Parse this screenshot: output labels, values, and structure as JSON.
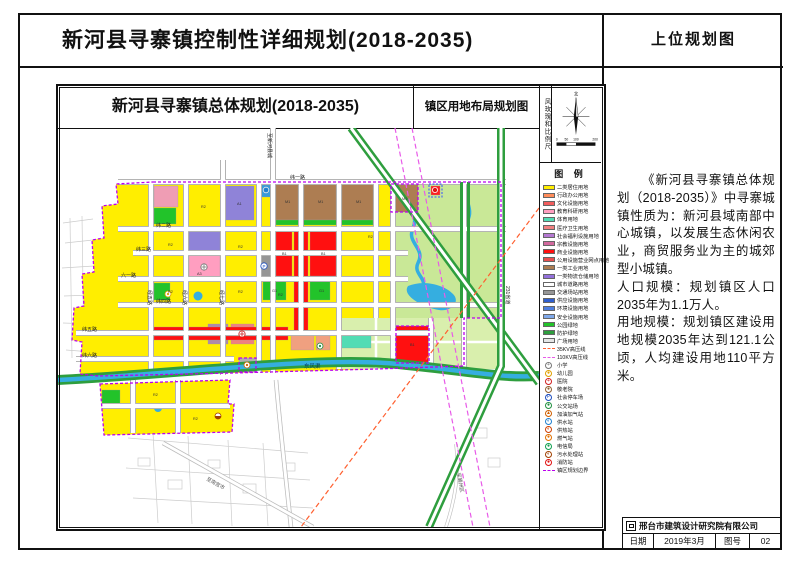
{
  "page": {
    "main_title": "新河县寻寨镇控制性详细规划(2018-2035)",
    "corner_title": "上位规划图"
  },
  "sheet": {
    "map_title": "新河县寻寨镇总体规划(2018-2035)",
    "map_subtitle": "镇区用地布局规划图",
    "side_strip": "风玫瑰和比例尺",
    "north_label": "北",
    "scale_ticks": [
      "0",
      "50",
      "100",
      "200"
    ]
  },
  "legend": {
    "title": "图 例",
    "items": [
      {
        "label": "二类居住用地",
        "kind": "area",
        "color": "#ffee00"
      },
      {
        "label": "行政办公用地",
        "kind": "area",
        "color": "#ff8c5a"
      },
      {
        "label": "文化设施用地",
        "kind": "area",
        "color": "#f25d5d"
      },
      {
        "label": "教育科研用地",
        "kind": "area",
        "color": "#ff9ec0"
      },
      {
        "label": "体育用地",
        "kind": "area",
        "color": "#52dcb4"
      },
      {
        "label": "医疗卫生用地",
        "kind": "area",
        "color": "#f08080"
      },
      {
        "label": "社会福利设施用地",
        "kind": "area",
        "color": "#b578d2"
      },
      {
        "label": "宗教设施用地",
        "kind": "area",
        "color": "#d2699e"
      },
      {
        "label": "商业设施用地",
        "kind": "area",
        "color": "#ff1010"
      },
      {
        "label": "公用设施营业网点用地",
        "kind": "area",
        "color": "#e85050"
      },
      {
        "label": "一类工业用地",
        "kind": "area",
        "color": "#ad7d52"
      },
      {
        "label": "一类物流仓储用地",
        "kind": "area",
        "color": "#9370db"
      },
      {
        "label": "城市道路用地",
        "kind": "area",
        "color": "#ffffff"
      },
      {
        "label": "交通场站用地",
        "kind": "area",
        "color": "#969696"
      },
      {
        "label": "供应设施用地",
        "kind": "area",
        "color": "#2f5fd0"
      },
      {
        "label": "环境设施用地",
        "kind": "area",
        "color": "#4f7fe0"
      },
      {
        "label": "安全设施用地",
        "kind": "area",
        "color": "#7fa8ea"
      },
      {
        "label": "公园绿地",
        "kind": "area",
        "color": "#22c32a"
      },
      {
        "label": "防护绿地",
        "kind": "area",
        "color": "#2e9e3e"
      },
      {
        "label": "广场用地",
        "kind": "area",
        "color": "#e6e6e6"
      },
      {
        "label": "35KV高压线",
        "kind": "line",
        "color": "#ff6030"
      },
      {
        "label": "110KV高压线",
        "kind": "line",
        "color": "#e85ae8"
      },
      {
        "label": "小学",
        "kind": "icon",
        "glyph": "+",
        "fg": "#777777"
      },
      {
        "label": "幼儿园",
        "kind": "icon",
        "glyph": "●",
        "fg": "#e0a000"
      },
      {
        "label": "医院",
        "kind": "icon",
        "glyph": "+",
        "fg": "#d02020"
      },
      {
        "label": "敬老院",
        "kind": "icon",
        "glyph": "●",
        "fg": "#906030"
      },
      {
        "label": "社会停车场",
        "kind": "icon",
        "glyph": "P",
        "fg": "#2050c0"
      },
      {
        "label": "公交站场",
        "kind": "icon",
        "glyph": "●",
        "fg": "#209040"
      },
      {
        "label": "加油加气站",
        "kind": "icon",
        "glyph": "▲",
        "fg": "#d06000"
      },
      {
        "label": "供水站",
        "kind": "icon",
        "glyph": "◐",
        "fg": "#2080d0"
      },
      {
        "label": "供热站",
        "kind": "icon",
        "glyph": "◐",
        "fg": "#d04000"
      },
      {
        "label": "燃气站",
        "kind": "icon",
        "glyph": "●",
        "fg": "#e07000"
      },
      {
        "label": "电信局",
        "kind": "icon",
        "glyph": "●",
        "fg": "#10a050"
      },
      {
        "label": "污水处理站",
        "kind": "icon",
        "glyph": "◐",
        "fg": "#a04000"
      },
      {
        "label": "消防站",
        "kind": "icon",
        "glyph": "●",
        "fg": "#e01010"
      },
      {
        "label": "镇区规划边界",
        "kind": "boundary",
        "color": "#bb00ee"
      }
    ]
  },
  "map": {
    "labels": [
      {
        "text": "纬一路",
        "x": 232,
        "y": 51,
        "s": 5
      },
      {
        "text": "纬二路",
        "x": 98,
        "y": 99,
        "s": 5
      },
      {
        "text": "纬三路",
        "x": 78,
        "y": 123,
        "s": 5
      },
      {
        "text": "六一路",
        "x": 63,
        "y": 149,
        "s": 5
      },
      {
        "text": "纬四路",
        "x": 98,
        "y": 175,
        "s": 5
      },
      {
        "text": "纬五路",
        "x": 24,
        "y": 203,
        "s": 5
      },
      {
        "text": "纬六路",
        "x": 24,
        "y": 229,
        "s": 5
      },
      {
        "text": "经五路",
        "x": 90,
        "y": 162,
        "s": 5,
        "rot": 90
      },
      {
        "text": "经六路",
        "x": 125,
        "y": 162,
        "s": 5,
        "rot": 90
      },
      {
        "text": "经七路",
        "x": 162,
        "y": 162,
        "s": 5,
        "rot": 90
      },
      {
        "text": "至新河县城",
        "x": 210,
        "y": 5,
        "s": 5,
        "rot": 90
      },
      {
        "text": "231省道",
        "x": 448,
        "y": 158,
        "s": 5,
        "rot": 90
      },
      {
        "text": "东风渠",
        "x": 246,
        "y": 240,
        "s": 5.5,
        "color": "#033a55"
      },
      {
        "text": "至南宫市",
        "x": 148,
        "y": 352,
        "s": 5,
        "rot": 29,
        "color": "#555555"
      },
      {
        "text": "至冀州区",
        "x": 399,
        "y": 345,
        "s": 5,
        "rot": 80,
        "color": "#555555"
      }
    ],
    "codes": [
      {
        "t": "R2",
        "x": 143,
        "y": 80
      },
      {
        "t": "R2",
        "x": 110,
        "y": 118
      },
      {
        "t": "R2",
        "x": 180,
        "y": 120
      },
      {
        "t": "R2",
        "x": 110,
        "y": 165
      },
      {
        "t": "R2",
        "x": 180,
        "y": 165
      },
      {
        "t": "R2",
        "x": 220,
        "y": 168
      },
      {
        "t": "R2",
        "x": 310,
        "y": 110
      },
      {
        "t": "R2",
        "x": 95,
        "y": 268
      },
      {
        "t": "R2",
        "x": 135,
        "y": 292
      },
      {
        "t": "M1",
        "x": 227,
        "y": 75
      },
      {
        "t": "M1",
        "x": 260,
        "y": 75
      },
      {
        "t": "M1",
        "x": 298,
        "y": 75
      },
      {
        "t": "M1",
        "x": 344,
        "y": 72
      },
      {
        "t": "B1",
        "x": 224,
        "y": 127
      },
      {
        "t": "B1",
        "x": 263,
        "y": 127
      },
      {
        "t": "B1",
        "x": 352,
        "y": 218
      },
      {
        "t": "A1",
        "x": 179,
        "y": 77
      },
      {
        "t": "A3",
        "x": 139,
        "y": 147
      },
      {
        "t": "G1",
        "x": 214,
        "y": 164
      },
      {
        "t": "G1",
        "x": 261,
        "y": 164
      }
    ]
  },
  "right_panel": {
    "p1": "《新河县寻寨镇总体规划（2018-2035）》中寻寨城镇性质为：新河县域南部中心城镇，以发展生态休闲农业，商贸服务业为主的城郊型小城镇。",
    "p2": "人口规模：规划镇区人口2035年为1.1万人。",
    "p3": "用地规模：规划镇区建设用地规模2035年达到121.1公顷，人均建设用地110平方米。"
  },
  "footer": {
    "company": "邢台市建筑设计研究院有限公司",
    "date_label": "日期",
    "date_value": "2019年3月",
    "sheet_label": "图号",
    "sheet_value": "02"
  }
}
